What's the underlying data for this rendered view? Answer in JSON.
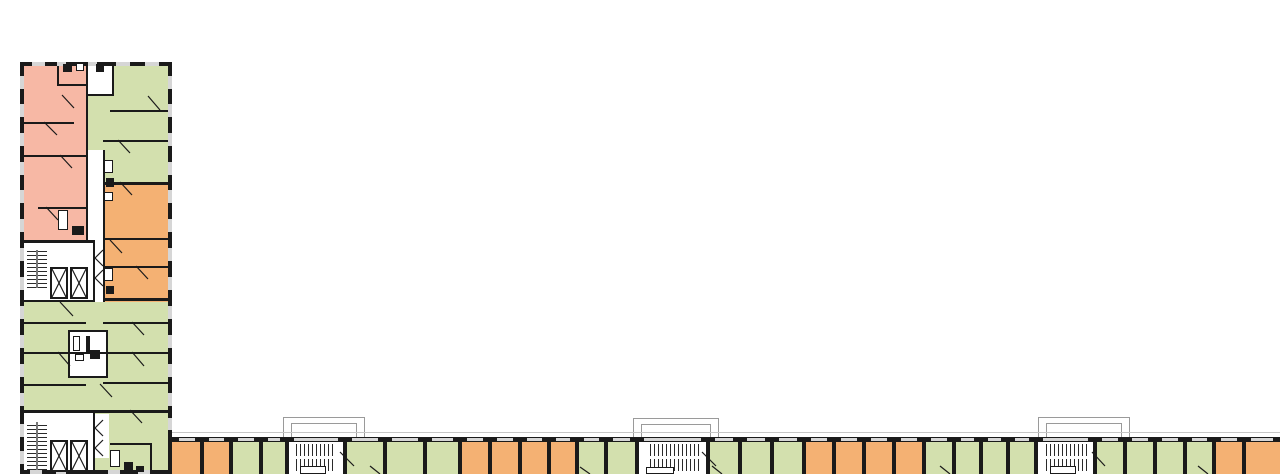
{
  "canvas": {
    "w": 1280,
    "h": 474
  },
  "palette": {
    "wall": "#1a1a1a",
    "pink": "#f7b8a5",
    "green": "#d3e0ae",
    "orange": "#f4b173",
    "window": "#d6d6d6",
    "balcony": "#9a9a9a",
    "hatch": "#2a2a2a",
    "roofline": "#c6c6c6"
  },
  "plan": {
    "rooms": [
      [
        "pink",
        24,
        66,
        62,
        174
      ],
      [
        "green",
        86,
        66,
        82,
        116
      ],
      [
        "orange",
        103,
        182,
        65,
        120
      ],
      [
        "green",
        24,
        302,
        144,
        110
      ],
      [
        "green",
        93,
        412,
        75,
        62
      ],
      [
        "orange",
        172,
        442,
        30,
        32
      ],
      [
        "orange",
        202,
        442,
        29,
        32
      ],
      [
        "green",
        231,
        442,
        30,
        32
      ],
      [
        "green",
        261,
        442,
        26,
        32
      ],
      [
        "white",
        287,
        442,
        58,
        32
      ],
      [
        "green",
        345,
        442,
        40,
        32
      ],
      [
        "green",
        385,
        442,
        40,
        32
      ],
      [
        "green",
        425,
        442,
        35,
        32
      ],
      [
        "orange",
        460,
        442,
        30,
        32
      ],
      [
        "orange",
        490,
        442,
        30,
        32
      ],
      [
        "orange",
        520,
        442,
        29,
        32
      ],
      [
        "orange",
        549,
        442,
        28,
        32
      ],
      [
        "green",
        577,
        442,
        29,
        32
      ],
      [
        "green",
        606,
        442,
        31,
        32
      ],
      [
        "white",
        637,
        442,
        71,
        32
      ],
      [
        "green",
        708,
        442,
        32,
        32
      ],
      [
        "green",
        740,
        442,
        32,
        32
      ],
      [
        "green",
        772,
        442,
        32,
        32
      ],
      [
        "orange",
        804,
        442,
        30,
        32
      ],
      [
        "orange",
        834,
        442,
        30,
        32
      ],
      [
        "orange",
        864,
        442,
        30,
        32
      ],
      [
        "orange",
        894,
        442,
        30,
        32
      ],
      [
        "green",
        924,
        442,
        30,
        32
      ],
      [
        "green",
        954,
        442,
        27,
        32
      ],
      [
        "green",
        981,
        442,
        27,
        32
      ],
      [
        "green",
        1008,
        442,
        28,
        32
      ],
      [
        "white",
        1036,
        442,
        59,
        32
      ],
      [
        "green",
        1095,
        442,
        30,
        32
      ],
      [
        "green",
        1125,
        442,
        30,
        32
      ],
      [
        "green",
        1155,
        442,
        30,
        32
      ],
      [
        "green",
        1185,
        442,
        29,
        32
      ],
      [
        "orange",
        1214,
        442,
        30,
        32
      ],
      [
        "orange",
        1244,
        442,
        36,
        32
      ]
    ],
    "white_areas": [
      [
        88,
        66,
        24,
        28
      ],
      [
        87,
        150,
        16,
        152
      ],
      [
        24,
        240,
        69,
        62
      ],
      [
        24,
        412,
        69,
        62
      ],
      [
        95,
        414,
        14,
        44
      ]
    ],
    "shafts": [
      [
        68,
        330,
        40,
        48
      ]
    ],
    "balconies": [
      [
        283,
        417,
        80,
        21
      ],
      [
        633,
        418,
        84,
        20
      ],
      [
        1038,
        417,
        90,
        21
      ]
    ],
    "roofline": [
      168,
      432,
      1112,
      1
    ],
    "walls": [
      [
        20,
        62,
        4,
        412
      ],
      [
        168,
        62,
        4,
        412
      ],
      [
        20,
        62,
        152,
        4
      ],
      [
        20,
        470,
        152,
        4
      ],
      [
        168,
        437,
        1112,
        5
      ],
      [
        86,
        66,
        2,
        174
      ],
      [
        93,
        240,
        2,
        62
      ],
      [
        103,
        150,
        2,
        152
      ],
      [
        57,
        66,
        2,
        20
      ],
      [
        57,
        84,
        30,
        2
      ],
      [
        112,
        66,
        2,
        28
      ],
      [
        86,
        94,
        28,
        2
      ],
      [
        24,
        122,
        50,
        2
      ],
      [
        24,
        155,
        62,
        2
      ],
      [
        38,
        207,
        48,
        2
      ],
      [
        24,
        240,
        70,
        3
      ],
      [
        24,
        300,
        70,
        2
      ],
      [
        110,
        110,
        58,
        2
      ],
      [
        103,
        140,
        65,
        2
      ],
      [
        103,
        182,
        65,
        3
      ],
      [
        103,
        238,
        65,
        2
      ],
      [
        103,
        266,
        65,
        2
      ],
      [
        103,
        298,
        65,
        3
      ],
      [
        24,
        322,
        62,
        2
      ],
      [
        103,
        322,
        65,
        2
      ],
      [
        24,
        352,
        144,
        2
      ],
      [
        24,
        384,
        62,
        2
      ],
      [
        103,
        382,
        65,
        2
      ],
      [
        24,
        410,
        144,
        3
      ],
      [
        93,
        412,
        2,
        62
      ],
      [
        110,
        443,
        42,
        2
      ],
      [
        150,
        443,
        2,
        31
      ]
    ],
    "windows": [
      [
        20,
        76,
        4,
        13
      ],
      [
        20,
        104,
        4,
        13
      ],
      [
        20,
        133,
        4,
        13
      ],
      [
        20,
        162,
        4,
        13
      ],
      [
        20,
        190,
        4,
        13
      ],
      [
        20,
        219,
        4,
        13
      ],
      [
        20,
        248,
        4,
        13
      ],
      [
        20,
        277,
        4,
        13
      ],
      [
        20,
        306,
        4,
        13
      ],
      [
        20,
        335,
        4,
        13
      ],
      [
        20,
        364,
        4,
        13
      ],
      [
        20,
        393,
        4,
        13
      ],
      [
        20,
        424,
        4,
        13
      ],
      [
        20,
        451,
        4,
        13
      ],
      [
        168,
        76,
        4,
        13
      ],
      [
        168,
        104,
        4,
        13
      ],
      [
        168,
        133,
        4,
        13
      ],
      [
        168,
        162,
        4,
        13
      ],
      [
        168,
        190,
        4,
        13
      ],
      [
        168,
        219,
        4,
        13
      ],
      [
        168,
        248,
        4,
        13
      ],
      [
        168,
        277,
        4,
        13
      ],
      [
        168,
        306,
        4,
        13
      ],
      [
        168,
        335,
        4,
        13
      ],
      [
        168,
        364,
        4,
        13
      ],
      [
        168,
        393,
        4,
        13
      ],
      [
        168,
        418,
        4,
        12
      ],
      [
        32,
        62,
        13,
        4
      ],
      [
        57,
        62,
        9,
        4
      ],
      [
        88,
        62,
        9,
        4
      ],
      [
        116,
        62,
        14,
        4
      ],
      [
        145,
        62,
        14,
        4
      ],
      [
        30,
        470,
        12,
        4
      ],
      [
        56,
        470,
        10,
        4
      ],
      [
        108,
        470,
        12,
        4
      ],
      [
        138,
        470,
        12,
        4
      ]
    ],
    "stairs": [
      [
        27,
        250,
        9,
        38,
        "h"
      ],
      [
        38,
        250,
        9,
        38,
        "h"
      ],
      [
        27,
        422,
        9,
        48,
        "h"
      ],
      [
        38,
        422,
        9,
        48,
        "h"
      ],
      [
        296,
        444,
        40,
        12,
        "v"
      ],
      [
        296,
        459,
        40,
        12,
        "v"
      ],
      [
        650,
        444,
        50,
        12,
        "v"
      ],
      [
        650,
        459,
        50,
        12,
        "v"
      ],
      [
        1046,
        444,
        42,
        12,
        "v"
      ],
      [
        1046,
        459,
        42,
        12,
        "v"
      ]
    ],
    "elevators": [
      [
        50,
        267,
        18,
        32
      ],
      [
        70,
        267,
        18,
        32
      ],
      [
        50,
        440,
        18,
        32
      ],
      [
        70,
        440,
        18,
        32
      ]
    ],
    "fixtures_solid": [
      [
        63,
        64,
        9,
        8
      ],
      [
        96,
        64,
        8,
        8
      ],
      [
        106,
        178,
        8,
        9
      ],
      [
        72,
        226,
        12,
        9
      ],
      [
        106,
        286,
        8,
        8
      ],
      [
        90,
        350,
        10,
        9
      ],
      [
        124,
        462,
        9,
        8
      ],
      [
        136,
        466,
        8,
        6
      ],
      [
        86,
        336,
        4,
        16
      ]
    ],
    "fixtures_outline": [
      [
        76,
        63,
        8,
        8
      ],
      [
        104,
        160,
        9,
        13
      ],
      [
        104,
        192,
        9,
        9
      ],
      [
        58,
        210,
        10,
        20
      ],
      [
        104,
        268,
        9,
        13
      ],
      [
        73,
        336,
        7,
        15
      ],
      [
        75,
        354,
        9,
        7
      ],
      [
        110,
        450,
        10,
        17
      ],
      [
        300,
        466,
        26,
        8
      ],
      [
        646,
        467,
        28,
        7
      ],
      [
        1050,
        466,
        26,
        8
      ]
    ],
    "lines": [
      [
        62,
        95,
        74,
        108
      ],
      [
        44,
        122,
        57,
        135
      ],
      [
        148,
        96,
        160,
        110
      ],
      [
        118,
        140,
        130,
        153
      ],
      [
        60,
        155,
        72,
        168
      ],
      [
        46,
        207,
        58,
        220
      ],
      [
        120,
        182,
        132,
        195
      ],
      [
        110,
        240,
        122,
        253
      ],
      [
        136,
        266,
        148,
        279
      ],
      [
        60,
        302,
        73,
        316
      ],
      [
        132,
        322,
        144,
        335
      ],
      [
        58,
        352,
        70,
        366
      ],
      [
        132,
        352,
        144,
        366
      ],
      [
        100,
        384,
        112,
        397
      ],
      [
        130,
        410,
        142,
        423
      ],
      [
        103,
        250,
        95,
        258
      ],
      [
        95,
        258,
        103,
        266
      ],
      [
        103,
        270,
        95,
        278
      ],
      [
        95,
        278,
        103,
        286
      ],
      [
        103,
        420,
        95,
        428
      ],
      [
        95,
        428,
        103,
        436
      ],
      [
        103,
        440,
        95,
        448
      ],
      [
        95,
        448,
        103,
        456
      ],
      [
        340,
        452,
        354,
        466
      ],
      [
        702,
        452,
        716,
        466
      ],
      [
        1092,
        452,
        1105,
        466
      ],
      [
        370,
        466,
        380,
        474
      ],
      [
        580,
        467,
        590,
        474
      ],
      [
        712,
        466,
        722,
        474
      ],
      [
        940,
        466,
        950,
        474
      ],
      [
        1198,
        466,
        1208,
        474
      ],
      [
        37,
        250,
        37,
        288
      ],
      [
        37,
        422,
        37,
        470
      ]
    ]
  }
}
